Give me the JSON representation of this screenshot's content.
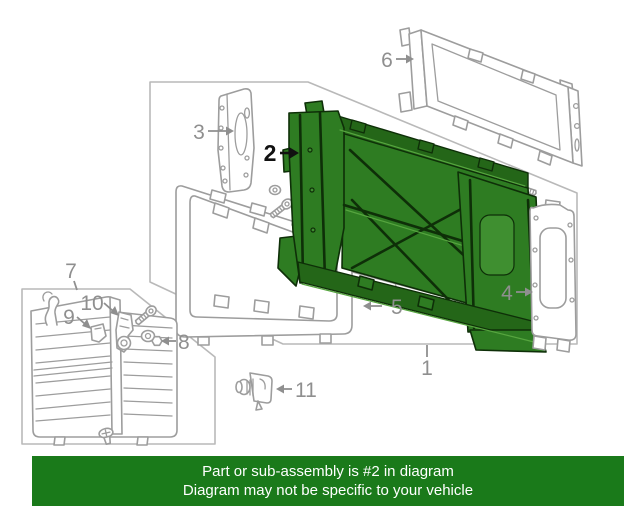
{
  "page": {
    "background_color": "#ffffff"
  },
  "diagram": {
    "highlighted_callout": "2",
    "callouts": [
      {
        "number": "1",
        "highlighted": false
      },
      {
        "number": "2",
        "highlighted": true
      },
      {
        "number": "3",
        "highlighted": false
      },
      {
        "number": "4",
        "highlighted": false
      },
      {
        "number": "5",
        "highlighted": false
      },
      {
        "number": "6",
        "highlighted": false
      },
      {
        "number": "7",
        "highlighted": false
      },
      {
        "number": "8",
        "highlighted": false
      },
      {
        "number": "9",
        "highlighted": false
      },
      {
        "number": "10",
        "highlighted": false
      },
      {
        "number": "11",
        "highlighted": false
      }
    ],
    "colors": {
      "part_line_gray": "#9d9d9d",
      "panel_border_gray": "#b9b9b9",
      "label_gray": "#8f8f8f",
      "highlight_fill_green": "#2e7c22",
      "highlight_outline_green": "#0e2f08",
      "highlighted_label_black": "#111111"
    }
  },
  "banner": {
    "line1": "Part or sub-assembly is #2 in diagram",
    "line2": "Diagram may not be specific to your vehicle",
    "background_color": "#1a7a1a",
    "text_color": "#ffffff"
  }
}
